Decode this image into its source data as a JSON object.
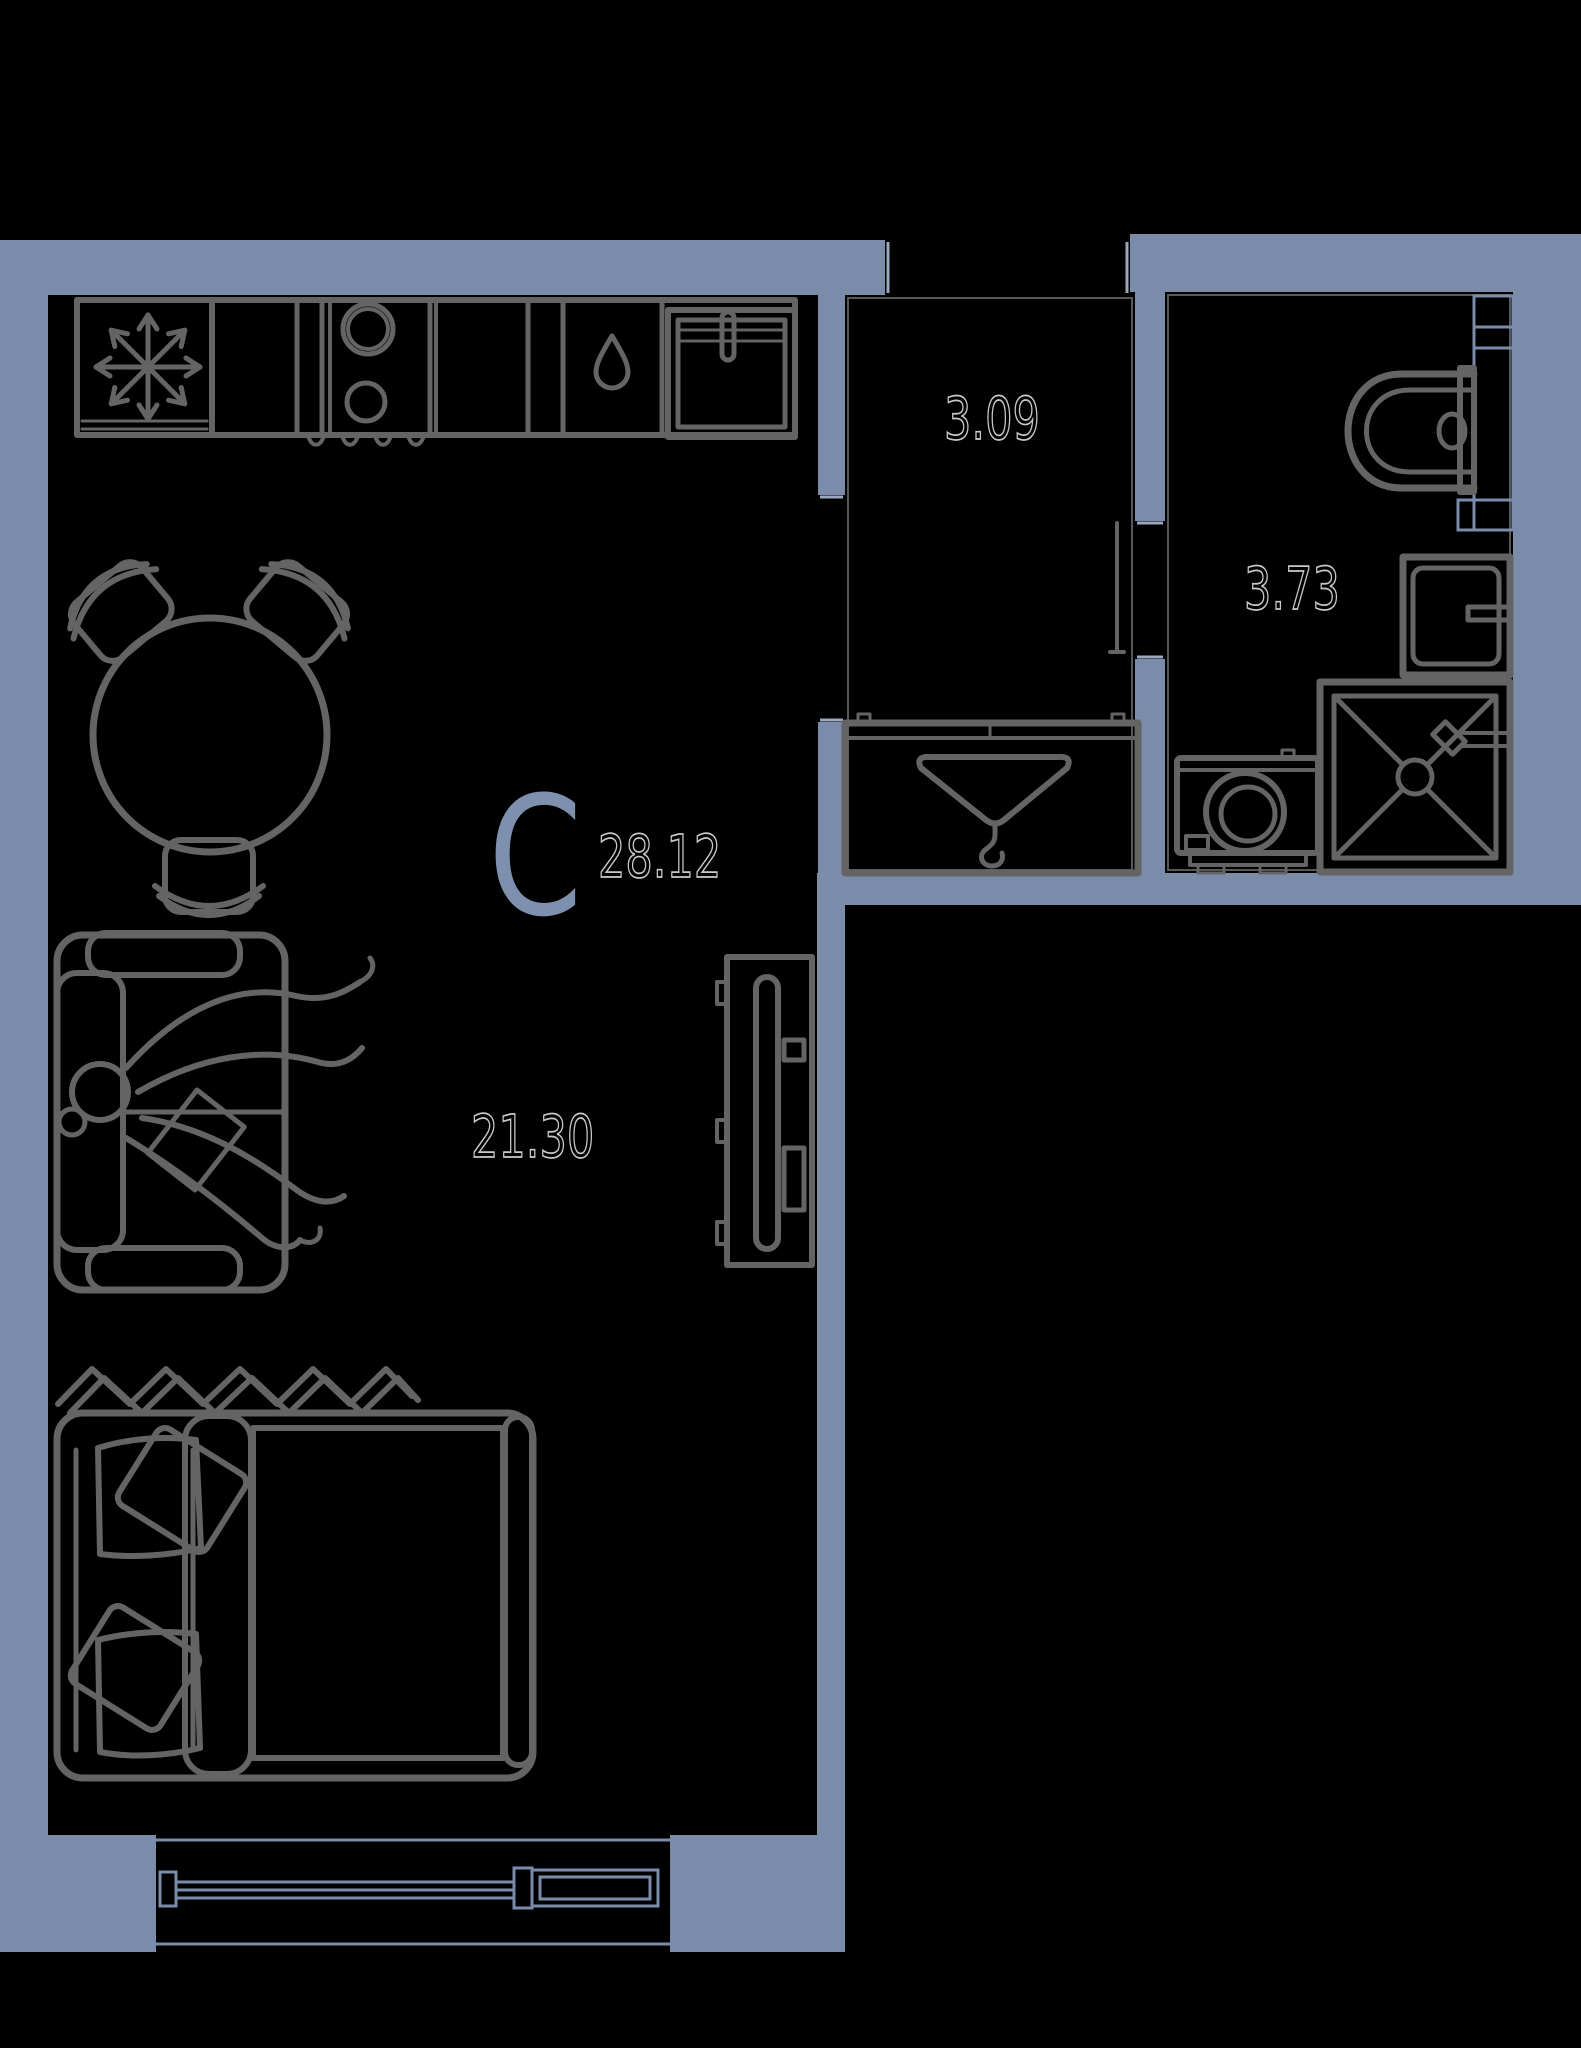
{
  "meta": {
    "title": "Studio apartment floor plan",
    "type": "floor-plan"
  },
  "colors": {
    "background": "#000000",
    "wall": "#7a8caa",
    "outline": "#646464",
    "jamb": "#9aa9c0",
    "unit": "#7d90ad",
    "area_outline": "#c9c9c9"
  },
  "plan": {
    "unit_label": "C",
    "total_area": "28.12",
    "rooms": [
      {
        "name": "living-room",
        "area": "21.30"
      },
      {
        "name": "hallway",
        "area": "3.09"
      },
      {
        "name": "bathroom",
        "area": "3.73"
      }
    ]
  }
}
